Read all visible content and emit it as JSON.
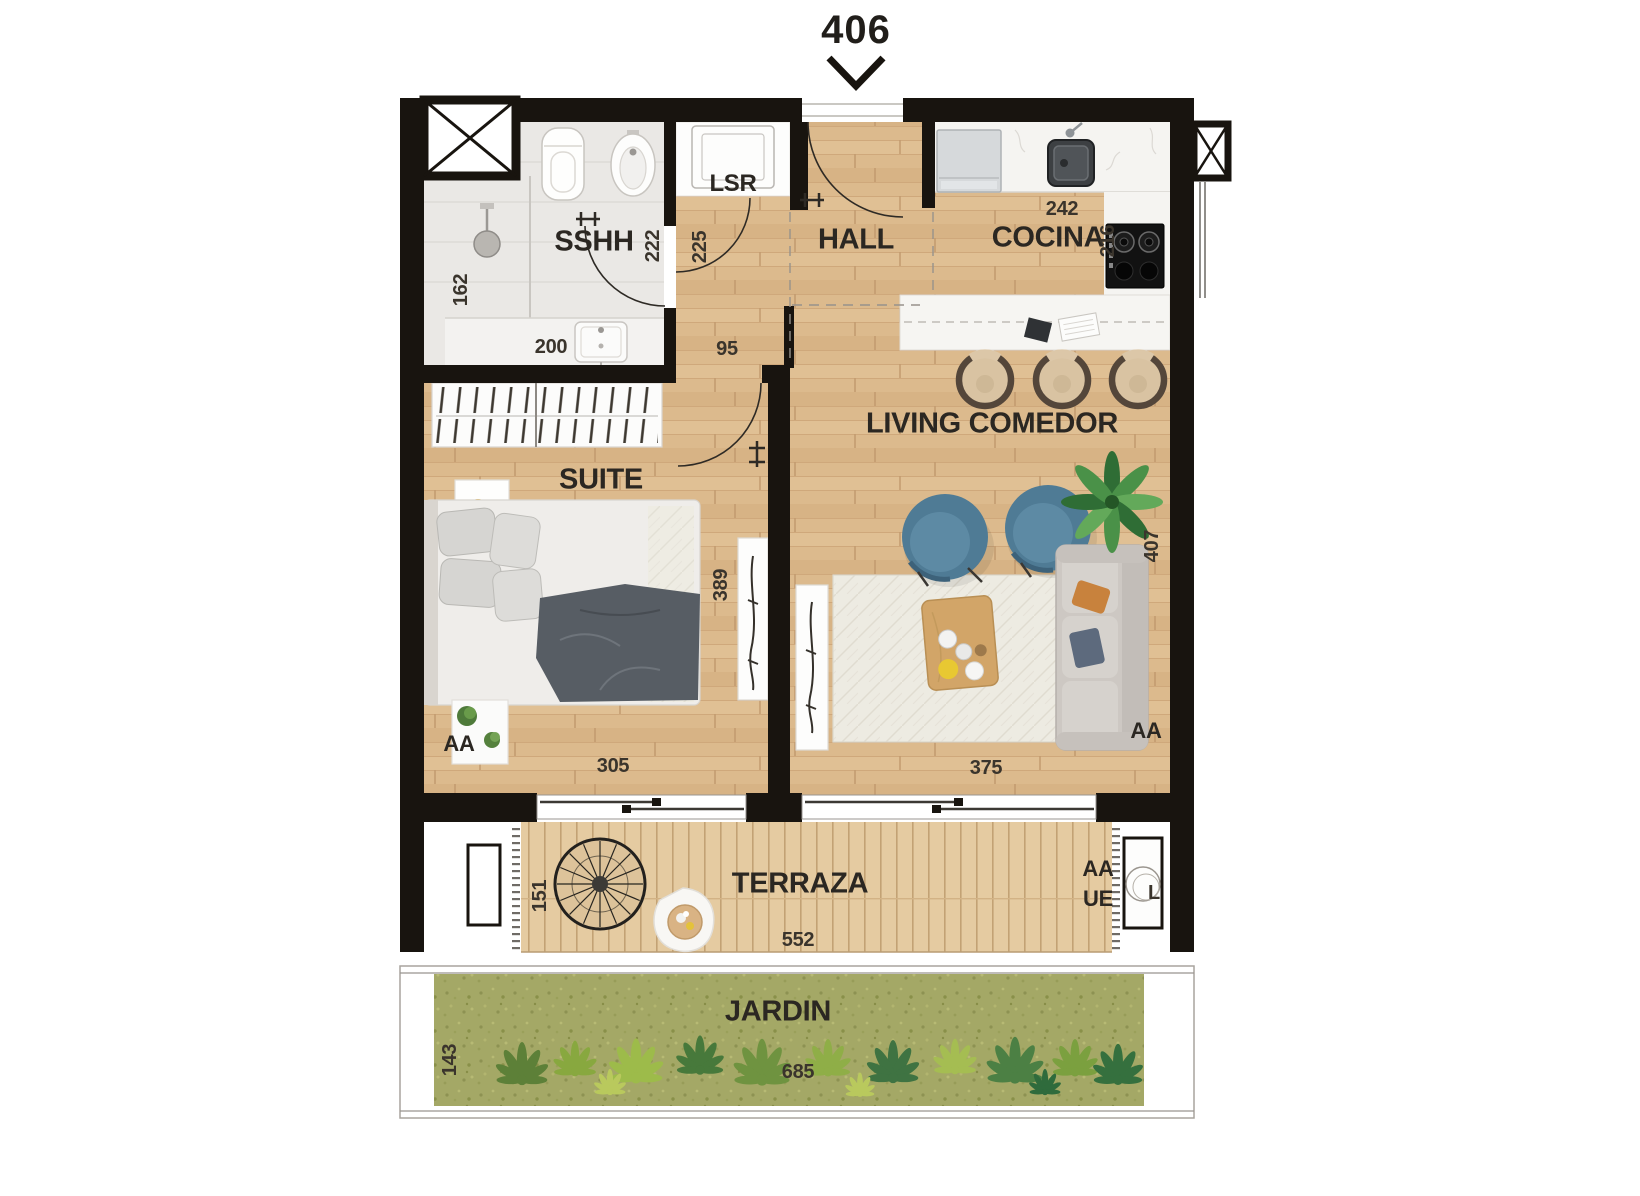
{
  "unit_number": "406",
  "rooms": {
    "sshh": "SSHH",
    "lsr": "LSR",
    "hall": "HALL",
    "cocina": "COCINA",
    "suite": "SUITE",
    "living_comedor": "LIVING COMEDOR",
    "terraza": "TERRAZA",
    "jardin": "JARDIN"
  },
  "dimensions": {
    "shower_width": "162",
    "sshh_width": "222",
    "vanity_width": "200",
    "corridor_depth": "225",
    "corridor_width": "95",
    "cocina_width": "242",
    "cocina_depth": "216",
    "suite_width": "305",
    "suite_depth": "389",
    "living_width": "375",
    "living_depth": "407",
    "terraza_depth": "151",
    "terraza_width": "552",
    "jardin_depth": "143",
    "jardin_width": "685"
  },
  "annotations": {
    "aa_suite": "AA",
    "aa_living": "AA",
    "aa_terraza": "AA",
    "ue_terraza": "UE",
    "l_terraza": "L"
  },
  "colors": {
    "wall": "#18140f",
    "wood_floor": "#dcba8d",
    "deck": "#e5cba1",
    "bathroom_tile": "#eae8e5",
    "grass": "#a4a866",
    "armchair_blue": "#4f7b95",
    "sofa_gray": "#cdc8c3",
    "text": "#2d2823"
  }
}
